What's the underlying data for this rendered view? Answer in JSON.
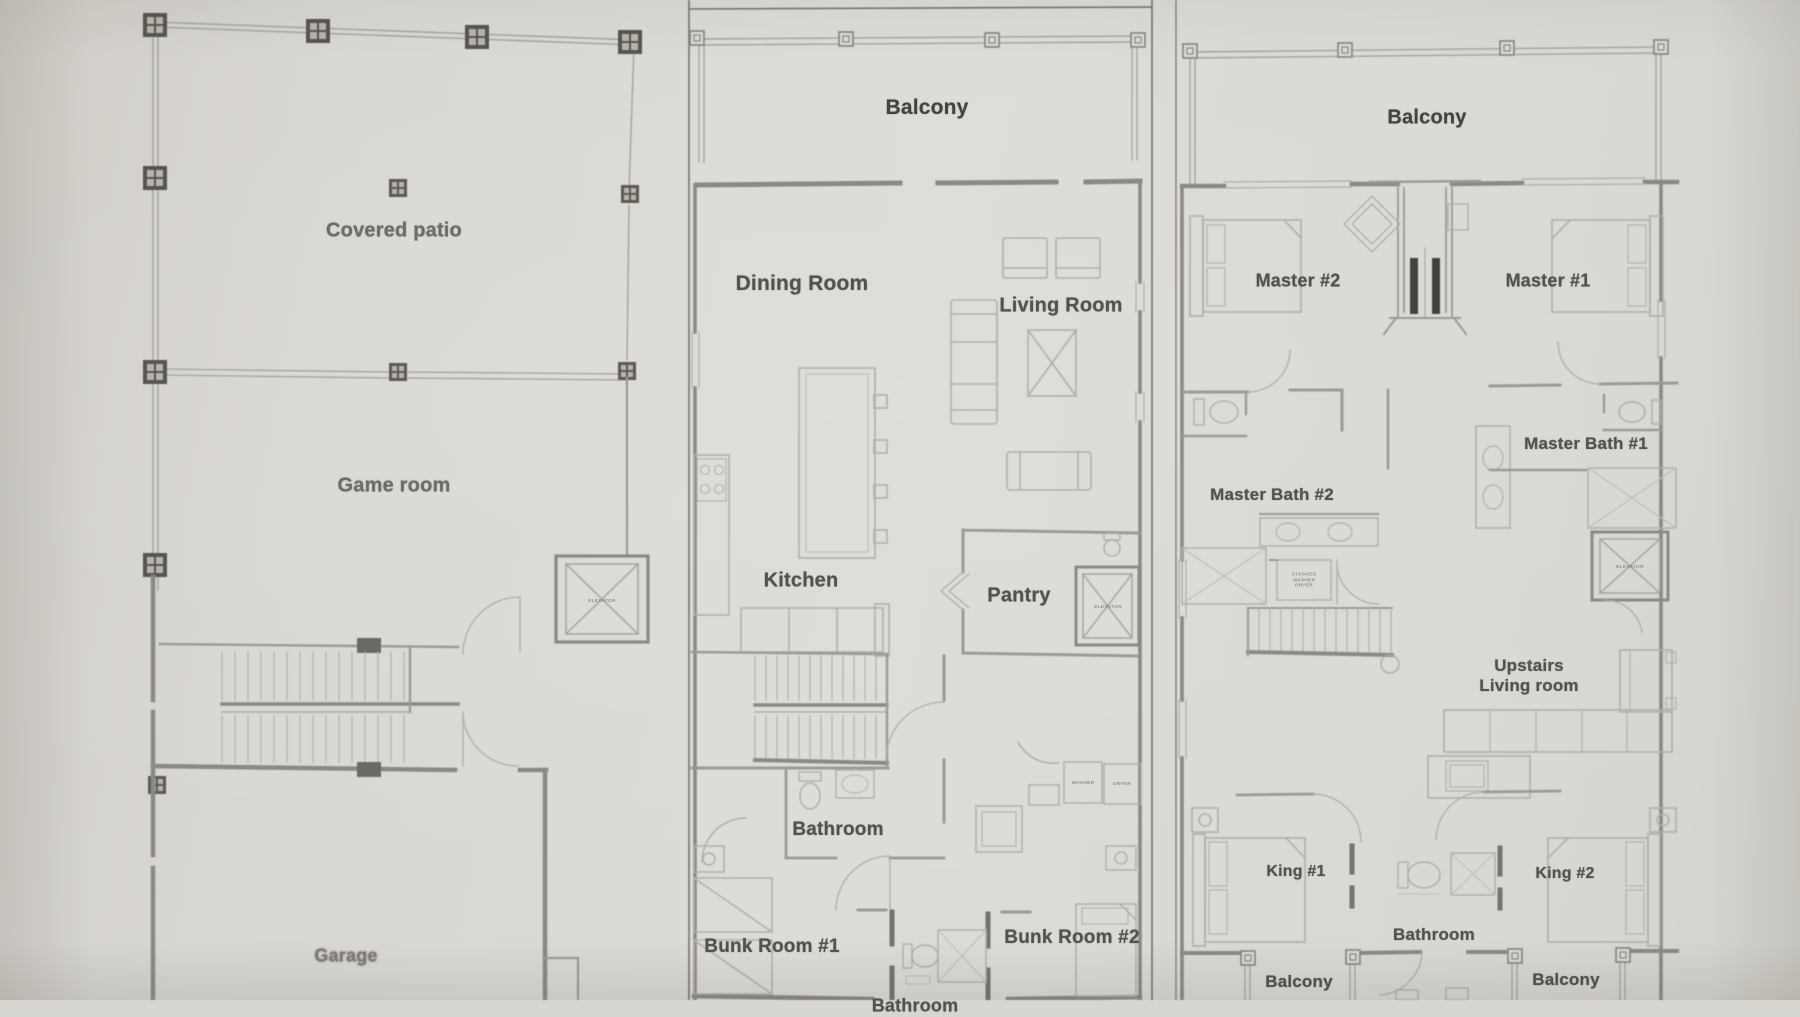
{
  "photo": {
    "paper_color": "#dcdad5",
    "wall_color": "#8a8a85",
    "thin_line_color": "#a9a9a4",
    "furniture_color": "#b0b0ab",
    "column_color": "#56544e",
    "text_color": "#54524d"
  },
  "ground_floor": {
    "labels": {
      "covered_patio": "Covered patio",
      "game_room": "Game room",
      "garage": "Garage"
    },
    "tiny": {
      "elevator": "ELEVATOR"
    }
  },
  "main_floor": {
    "labels": {
      "balcony": "Balcony",
      "dining_room": "Dining Room",
      "living_room": "Living Room",
      "kitchen": "Kitchen",
      "pantry": "Pantry",
      "bathroom": "Bathroom",
      "bunk_room_1": "Bunk Room #1",
      "bunk_room_2": "Bunk Room #2",
      "bathroom_partial": "Bathroom"
    },
    "tiny": {
      "elevator": "ELEVATOR",
      "washer": "WASHER",
      "dryer": "DRYER"
    }
  },
  "upper_floor": {
    "labels": {
      "balcony": "Balcony",
      "master_2": "Master #2",
      "master_1": "Master #1",
      "master_bath_2": "Master Bath #2",
      "master_bath_1": "Master Bath #1",
      "upstairs_living": "Upstairs Living room",
      "king_1": "King #1",
      "king_2": "King #2",
      "bathroom": "Bathroom",
      "balcony_left": "Balcony",
      "balcony_right": "Balcony"
    },
    "tiny": {
      "elevator": "ELEVATOR",
      "stacked_wd": "STACKED WASHER DRYER"
    }
  }
}
